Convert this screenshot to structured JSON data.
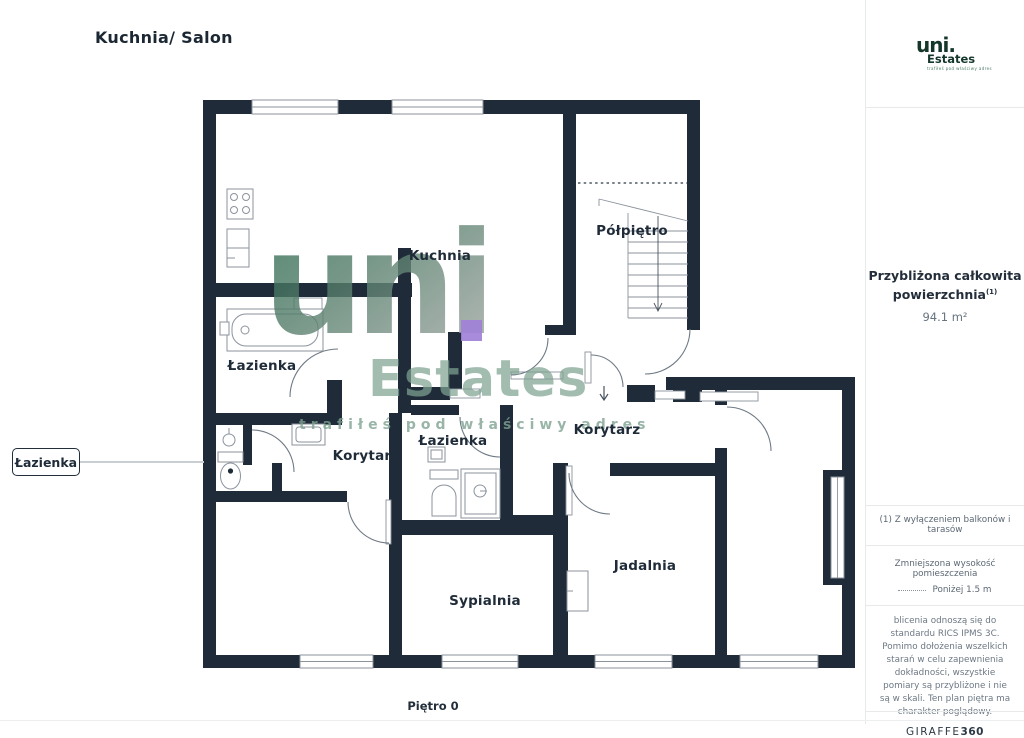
{
  "page": {
    "title": "Kuchnia/ Salon",
    "floor_label": "Piętro 0"
  },
  "branding": {
    "logo": {
      "name": "uni.",
      "suffix": "Estates",
      "tagline": "trafiłeś pod właściwy adres"
    },
    "watermark": {
      "name": "uni",
      "dot_color": "#A181D8",
      "suffix": "Estates",
      "tagline": "trafiłeś pod właściwy adres"
    }
  },
  "sidebar": {
    "area": {
      "label_line1": "Przybliżona całkowita",
      "label_line2": "powierzchnia",
      "superscript": "(1)",
      "value": "94.1 m²"
    },
    "footnote": "(1) Z wyłączeniem balkonów i tarasów",
    "height_note": {
      "title": "Zmniejszona wysokość pomieszczenia",
      "legend": "Poniżej 1.5 m"
    },
    "disclaimer": "blicenia odnoszą się do standardu RICS IPMS 3C. Pomimo dołożenia wszelkich starań w celu zapewnienia dokładności, wszystkie pomiary są przybliżone i nie są w skali. Ten plan piętra ma charakter poglądowy.",
    "brand_footer": {
      "name": "GIRAFFE",
      "bold": "360"
    }
  },
  "plan": {
    "callout": {
      "label": "Łazienka"
    },
    "rooms": [
      {
        "id": "kuchnia",
        "label": "Kuchnia",
        "x": 440,
        "y": 256
      },
      {
        "id": "polpietro",
        "label": "Półpiętro",
        "x": 632,
        "y": 231
      },
      {
        "id": "lazienka-left",
        "label": "Łazienka",
        "x": 262,
        "y": 366
      },
      {
        "id": "korytarz-left",
        "label": "Korytarz",
        "x": 366,
        "y": 456
      },
      {
        "id": "lazienka-mid",
        "label": "Łazienka",
        "x": 453,
        "y": 441
      },
      {
        "id": "korytarz-right",
        "label": "Korytarz",
        "x": 607,
        "y": 430
      },
      {
        "id": "jadalnia",
        "label": "Jadalnia",
        "x": 645,
        "y": 566
      },
      {
        "id": "sypialnia",
        "label": "Sypialnia",
        "x": 485,
        "y": 601
      }
    ],
    "fixtures": [
      "stove-icon",
      "kitchen-sink-icon",
      "bathtub-icon",
      "toilet-icon",
      "shower-icon",
      "washing-machine-icon",
      "radiator-icon",
      "stairs-icon",
      "window-icon"
    ],
    "colors": {
      "wall": "#1F2B38",
      "fixture_stroke": "#8B939C",
      "door_arc": "#6F7A85",
      "callout_line": "#C9CED3"
    }
  }
}
